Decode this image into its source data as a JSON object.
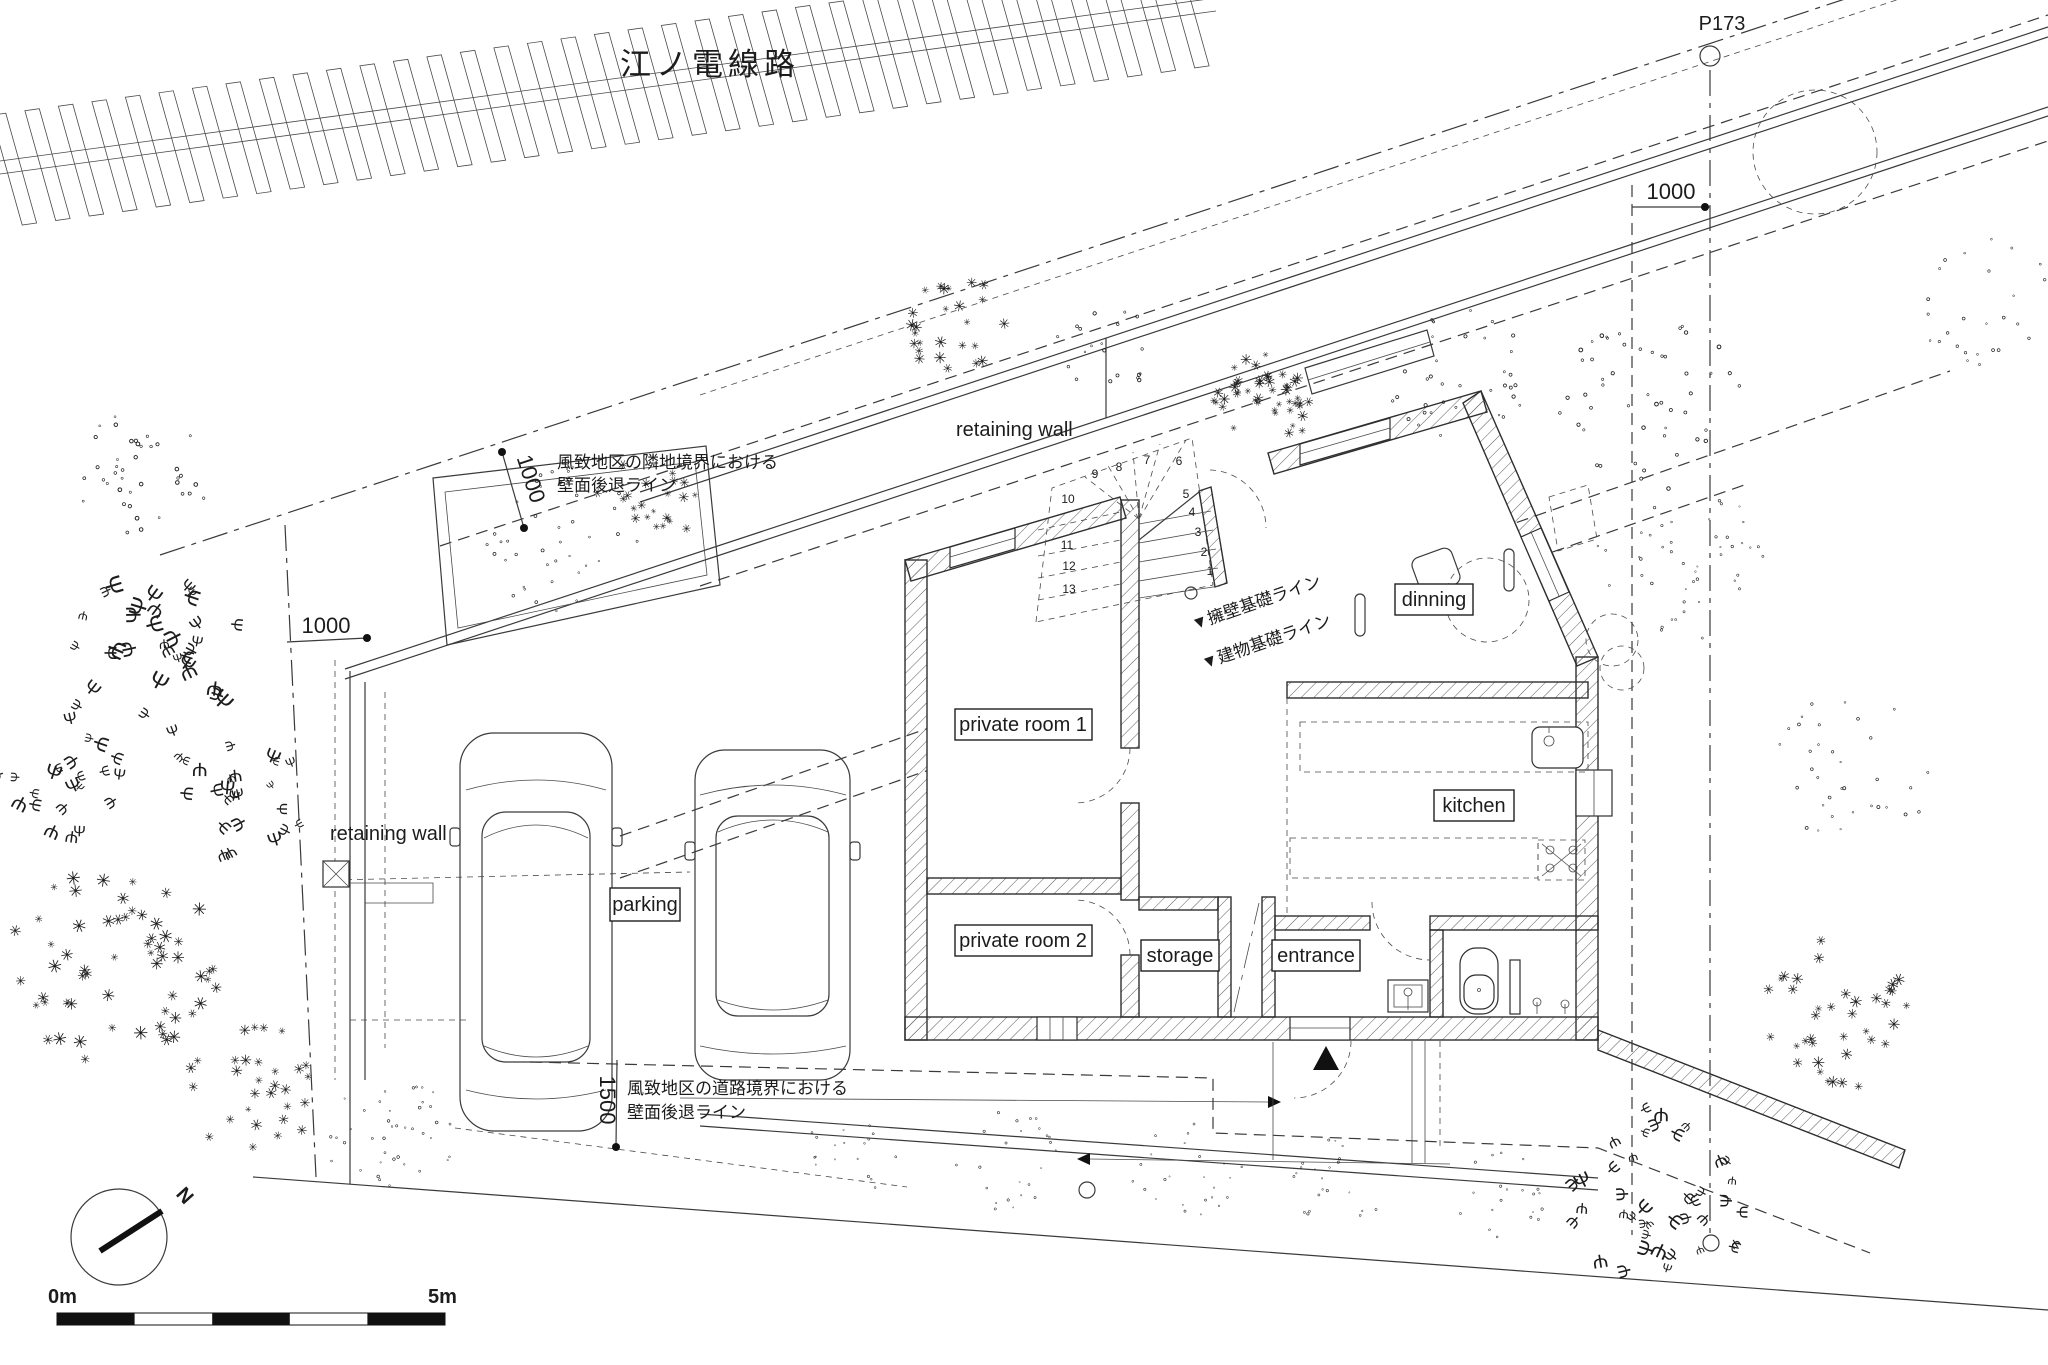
{
  "railway": {
    "name": "江ノ電線路"
  },
  "survey": {
    "marker": "P173"
  },
  "dimensions": {
    "top_left": "1000",
    "top_right": "1000",
    "west": "1000",
    "south": "1500"
  },
  "annotations": {
    "neighbor_setback_l1": "風致地区の隣地境界における",
    "neighbor_setback_l2": "壁面後退ライン",
    "road_setback_l1": "風致地区の道路境界における",
    "road_setback_l2": "壁面後退ライン",
    "wall_foundation": "▼擁壁基礎ライン",
    "building_foundation": "▼建物基礎ライン",
    "retaining_wall_top": "retaining wall",
    "retaining_wall_west": "retaining wall"
  },
  "rooms": {
    "private_room_1": "private room 1",
    "private_room_2": "private room 2",
    "storage": "storage",
    "entrance": "entrance",
    "kitchen": "kitchen",
    "dinning": "dinning",
    "parking": "parking"
  },
  "stairs": {
    "numbers": [
      "1",
      "2",
      "3",
      "4",
      "5",
      "6",
      "7",
      "8",
      "9",
      "10",
      "11",
      "12",
      "13"
    ]
  },
  "compass": {
    "north": "N"
  },
  "scale_bar": {
    "start": "0m",
    "end": "5m"
  },
  "colors": {
    "paper": "#ffffff",
    "ink": "#3a3a3a",
    "text": "#1c1c1c",
    "vegetation_light": "#9a9a9a",
    "vegetation_dark": "#555555"
  },
  "vegetation": [
    {
      "cx": 140,
      "cy": 478,
      "r": 72,
      "n": 40,
      "size": 11,
      "glyph": "∘",
      "color": "#8f8f8f",
      "seed": 11
    },
    {
      "cx": 150,
      "cy": 655,
      "r": 95,
      "n": 34,
      "size": 17,
      "glyph": "Ψ",
      "color": "#9a9a9a",
      "seed": 22
    },
    {
      "cx": 70,
      "cy": 780,
      "r": 70,
      "n": 22,
      "size": 15,
      "glyph": "Ψ",
      "color": "#9a9a9a",
      "seed": 33
    },
    {
      "cx": 235,
      "cy": 795,
      "r": 72,
      "n": 24,
      "size": 14,
      "glyph": "Ψ",
      "color": "#a0a0a0",
      "seed": 44
    },
    {
      "cx": 115,
      "cy": 965,
      "r": 105,
      "n": 60,
      "size": 13,
      "glyph": "✳",
      "color": "#6f6f6f",
      "seed": 55
    },
    {
      "cx": 250,
      "cy": 1085,
      "r": 68,
      "n": 30,
      "size": 11,
      "glyph": "✳",
      "color": "#8a8a8a",
      "seed": 66
    },
    {
      "cx": 395,
      "cy": 1140,
      "r": 66,
      "n": 40,
      "size": 8,
      "glyph": "∘",
      "color": "#9a9a9a",
      "seed": 77
    },
    {
      "cx": 560,
      "cy": 540,
      "r": 78,
      "n": 40,
      "size": 9,
      "glyph": "∘",
      "color": "#9a9a9a",
      "seed": 88
    },
    {
      "cx": 648,
      "cy": 505,
      "r": 48,
      "n": 22,
      "size": 10,
      "glyph": "✳",
      "color": "#9a9a9a",
      "seed": 99
    },
    {
      "cx": 960,
      "cy": 325,
      "r": 55,
      "n": 26,
      "size": 12,
      "glyph": "✳",
      "color": "#8f8f8f",
      "seed": 110
    },
    {
      "cx": 1105,
      "cy": 350,
      "r": 48,
      "n": 20,
      "size": 10,
      "glyph": "∘",
      "color": "#a5a5a5",
      "seed": 121
    },
    {
      "cx": 1264,
      "cy": 398,
      "r": 50,
      "n": 45,
      "size": 11,
      "glyph": "✳",
      "color": "#555555",
      "seed": 132
    },
    {
      "cx": 1455,
      "cy": 372,
      "r": 72,
      "n": 36,
      "size": 10,
      "glyph": "∘",
      "color": "#9a9a9a",
      "seed": 143
    },
    {
      "cx": 1650,
      "cy": 405,
      "r": 92,
      "n": 50,
      "size": 11,
      "glyph": "∘",
      "color": "#8a8a8a",
      "seed": 154
    },
    {
      "cx": 1680,
      "cy": 565,
      "r": 88,
      "n": 46,
      "size": 8,
      "glyph": "∘",
      "color": "#9a9a9a",
      "seed": 165
    },
    {
      "cx": 1990,
      "cy": 300,
      "r": 75,
      "n": 30,
      "size": 9,
      "glyph": "∘",
      "color": "#a8a8a8",
      "seed": 176
    },
    {
      "cx": 1850,
      "cy": 770,
      "r": 80,
      "n": 34,
      "size": 9,
      "glyph": "∘",
      "color": "#a8a8a8",
      "seed": 187
    },
    {
      "cx": 1830,
      "cy": 1015,
      "r": 80,
      "n": 38,
      "size": 12,
      "glyph": "✳",
      "color": "#8a8a8a",
      "seed": 198
    },
    {
      "cx": 1665,
      "cy": 1195,
      "r": 95,
      "n": 40,
      "size": 15,
      "glyph": "Ψ",
      "color": "#9a9a9a",
      "seed": 209
    },
    {
      "cx": 855,
      "cy": 1150,
      "r": 48,
      "n": 18,
      "size": 7,
      "glyph": "∘",
      "color": "#a0a0a0",
      "seed": 220
    },
    {
      "cx": 1005,
      "cy": 1160,
      "r": 55,
      "n": 24,
      "size": 7,
      "glyph": "∘",
      "color": "#a0a0a0",
      "seed": 231
    },
    {
      "cx": 1185,
      "cy": 1172,
      "r": 55,
      "n": 24,
      "size": 7,
      "glyph": "∘",
      "color": "#a0a0a0",
      "seed": 242
    },
    {
      "cx": 1340,
      "cy": 1182,
      "r": 52,
      "n": 22,
      "size": 7,
      "glyph": "∘",
      "color": "#a0a0a0",
      "seed": 253
    },
    {
      "cx": 1500,
      "cy": 1192,
      "r": 50,
      "n": 20,
      "size": 7,
      "glyph": "∘",
      "color": "#a0a0a0",
      "seed": 264
    }
  ]
}
